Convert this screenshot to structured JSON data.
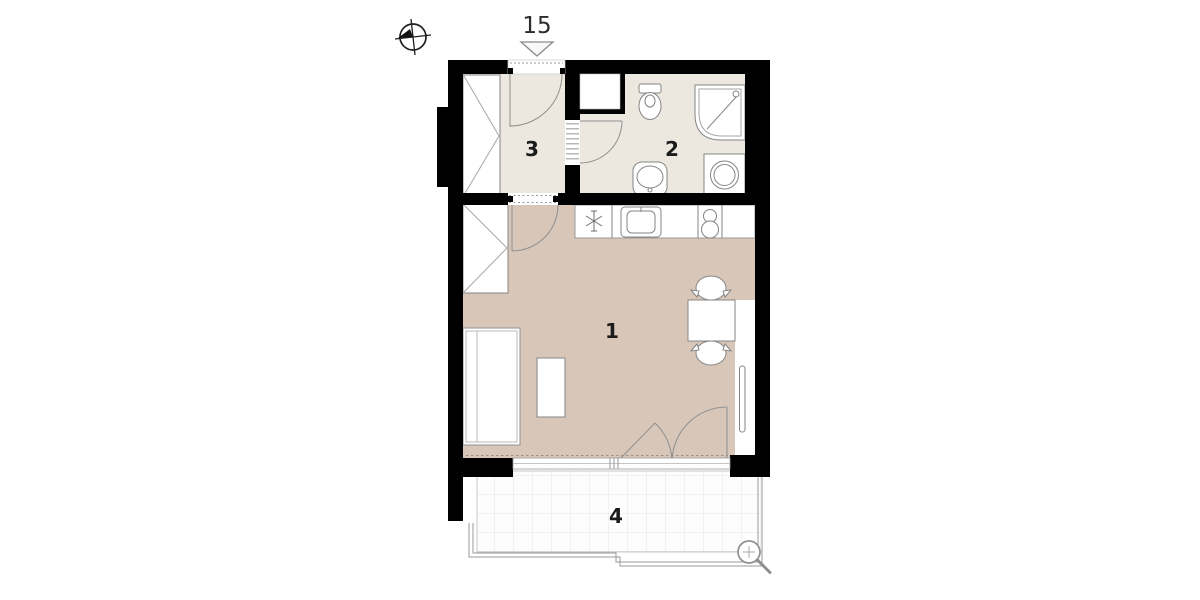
{
  "plan": {
    "entrance": {
      "unit_label": "15"
    },
    "rooms": [
      {
        "number": "1"
      },
      {
        "number": "2"
      },
      {
        "number": "3"
      },
      {
        "number": "4"
      }
    ],
    "colors": {
      "wall": "#000000",
      "living_floor": "#d8c7b9",
      "wet_floor": "#ece8e0",
      "fixture_outline": "#858585",
      "balcony_grid_line": "#e5e5e5"
    },
    "icons": {
      "compass": "north-compass-icon",
      "entrance_marker": "entrance-arrow-icon",
      "magnifier": "zoom-icon"
    }
  }
}
